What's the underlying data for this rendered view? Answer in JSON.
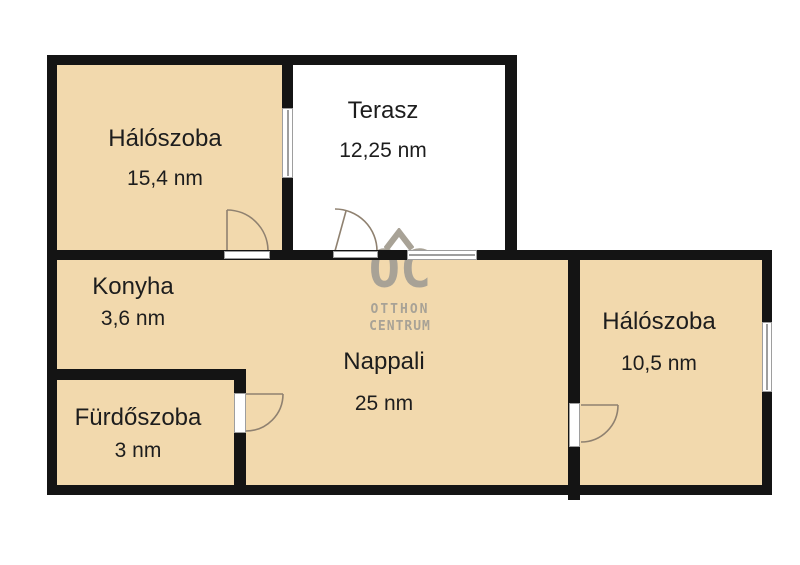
{
  "floorplan": {
    "rooms": {
      "bedroom1": {
        "name": "Hálószoba",
        "area": "15,4 nm"
      },
      "terrace": {
        "name": "Terasz",
        "area": "12,25 nm"
      },
      "kitchen": {
        "name": "Konyha",
        "area": "3,6 nm"
      },
      "living": {
        "name": "Nappali",
        "area": "25 nm"
      },
      "bathroom": {
        "name": "Fürdőszoba",
        "area": "3 nm"
      },
      "bedroom2": {
        "name": "Hálószoba",
        "area": "10,5 nm"
      }
    },
    "watermark": {
      "logo": "OC",
      "line1": "OTTHON",
      "line2": "CENTRUM"
    },
    "colors": {
      "room_fill": "#f2d9ad",
      "terrace_fill": "#ffffff",
      "wall": "#141414",
      "watermark": "#a8a296",
      "window_frame": "#9e9e9e",
      "door_arc": "#8f8170"
    }
  }
}
